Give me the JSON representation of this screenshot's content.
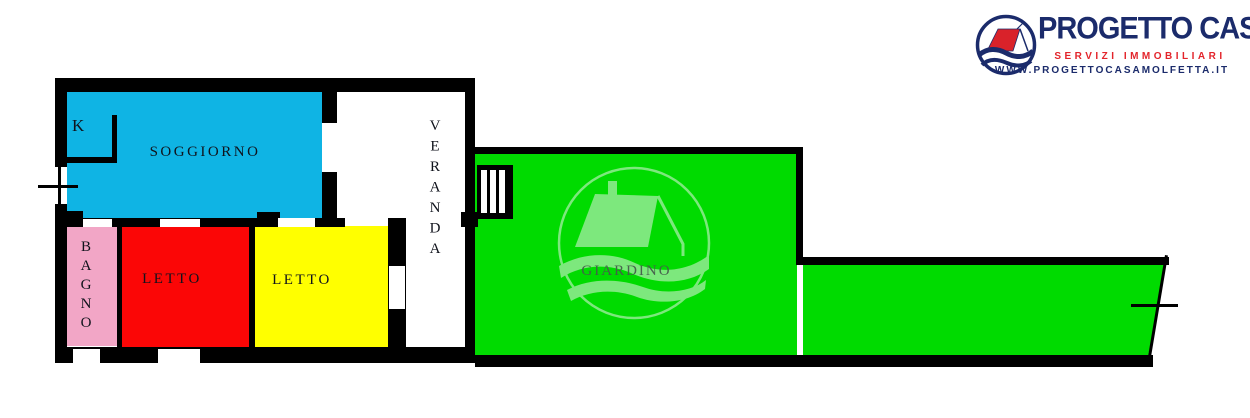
{
  "plan": {
    "rooms": {
      "kitchen": {
        "label": "K",
        "color": "#0FB4E4"
      },
      "soggiorno": {
        "label": "SOGGIORNO",
        "color": "#0FB4E4"
      },
      "bagno": {
        "label": "BAGNO",
        "color": "#F2A6C6"
      },
      "letto_1": {
        "label": "LETTO",
        "color": "#FB0606"
      },
      "letto_2": {
        "label": "LETTO",
        "color": "#FFFF00"
      },
      "veranda": {
        "label": "VERANDA",
        "color": "#FFFFFF"
      },
      "giardino": {
        "label": "GIARDINO",
        "color": "#00DB00"
      }
    },
    "wall_color": "#000000",
    "watermark_color": "#7DE87D"
  },
  "logo": {
    "brand": "PROGETTO CASA",
    "tagline": "SERVIZI IMMOBILIARI",
    "website": "WWW.PROGETTOCASAMOLFETTA.IT",
    "brand_color": "#1B2B6B",
    "tagline_color": "#E3242B",
    "roof_color": "#D9222A"
  }
}
